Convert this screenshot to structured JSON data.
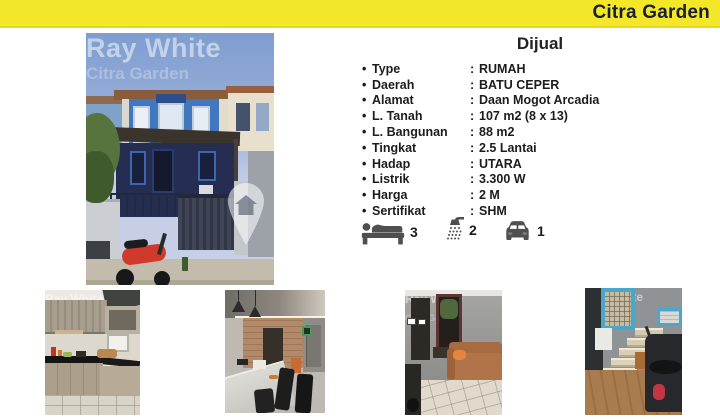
{
  "header": {
    "title": "Citra Garden"
  },
  "colors": {
    "accent_yellow": "#F3E72A",
    "header_text": "#1A1F33",
    "body_text": "#1C1C1C",
    "icon_gray": "#4F4F4F"
  },
  "listing": {
    "heading": "Dijual",
    "bullet": "•",
    "separator": ":",
    "details": [
      {
        "label": "Type",
        "value": "RUMAH"
      },
      {
        "label": "Daerah",
        "value": "BATU CEPER"
      },
      {
        "label": "Alamat",
        "value": "Daan Mogot Arcadia"
      },
      {
        "label": "L. Tanah",
        "value": "107 m2 (8 x 13)"
      },
      {
        "label": "L. Bangunan",
        "value": "88 m2"
      },
      {
        "label": "Tingkat",
        "value": "2.5 Lantai"
      },
      {
        "label": "Hadap",
        "value": "UTARA"
      },
      {
        "label": "Listrik",
        "value": "3.300 W"
      },
      {
        "label": "Harga",
        "value": "2 M"
      },
      {
        "label": "Sertifikat",
        "value": "SHM"
      }
    ],
    "features": [
      {
        "name": "bedrooms",
        "icon": "bed-icon",
        "count": "3"
      },
      {
        "name": "bathrooms",
        "icon": "shower-icon",
        "count": "2"
      },
      {
        "name": "carport",
        "icon": "car-icon",
        "count": "1"
      }
    ]
  },
  "watermark": {
    "brand": "Ray White",
    "office": "Citra Garden"
  },
  "photos": {
    "main": {
      "name": "house-exterior-front"
    },
    "gallery": [
      {
        "name": "kitchen"
      },
      {
        "name": "dining-room"
      },
      {
        "name": "living-room"
      },
      {
        "name": "staircase"
      }
    ]
  }
}
